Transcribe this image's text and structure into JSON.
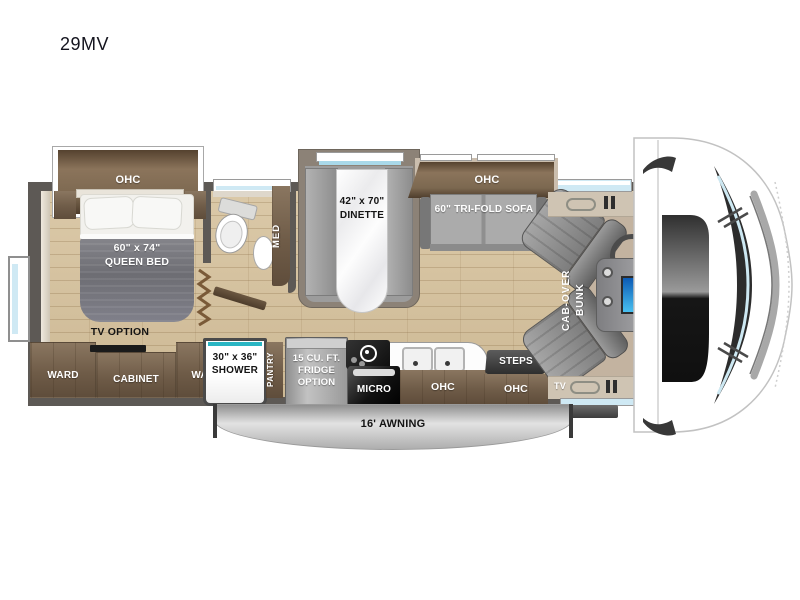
{
  "title": "29MV",
  "colors": {
    "accent_teal": "#2ab5c3",
    "window_blue": "#cfe9f4",
    "cabinet_brown": "#6f5c48",
    "wall_gray": "#5d5955",
    "floor_wood": "#d8c6a5",
    "dash_screen_blue": "#1d7fd6",
    "awning_silver": "#c9c9c9"
  },
  "bedroom": {
    "ohc": "OHC",
    "bed_size": "60\" x 74\"",
    "bed_name": "QUEEN BED",
    "tv_option": "TV OPTION",
    "ward_left": "WARD",
    "cabinet": "CABINET",
    "ward_right": "WARD"
  },
  "bathroom": {
    "med": "MED",
    "shower_size": "30\" x 36\"",
    "shower_name": "SHOWER"
  },
  "kitchen": {
    "pantry": "PANTRY",
    "fridge_line1": "15 CU. FT.",
    "fridge_line2": "FRIDGE",
    "fridge_line3": "OPTION",
    "micro": "MICRO",
    "ohc": "OHC"
  },
  "living": {
    "dinette_size": "42\" x 70\"",
    "dinette_name": "DINETTE",
    "sofa_ohc": "OHC",
    "sofa": "60\" TRI-FOLD SOFA"
  },
  "entry": {
    "steps": "STEPS",
    "ohc": "OHC",
    "tv": "TV"
  },
  "cab": {
    "bunk_line1": "CAB-OVER",
    "bunk_line2": "BUNK"
  },
  "exterior": {
    "awning": "16' AWNING"
  }
}
